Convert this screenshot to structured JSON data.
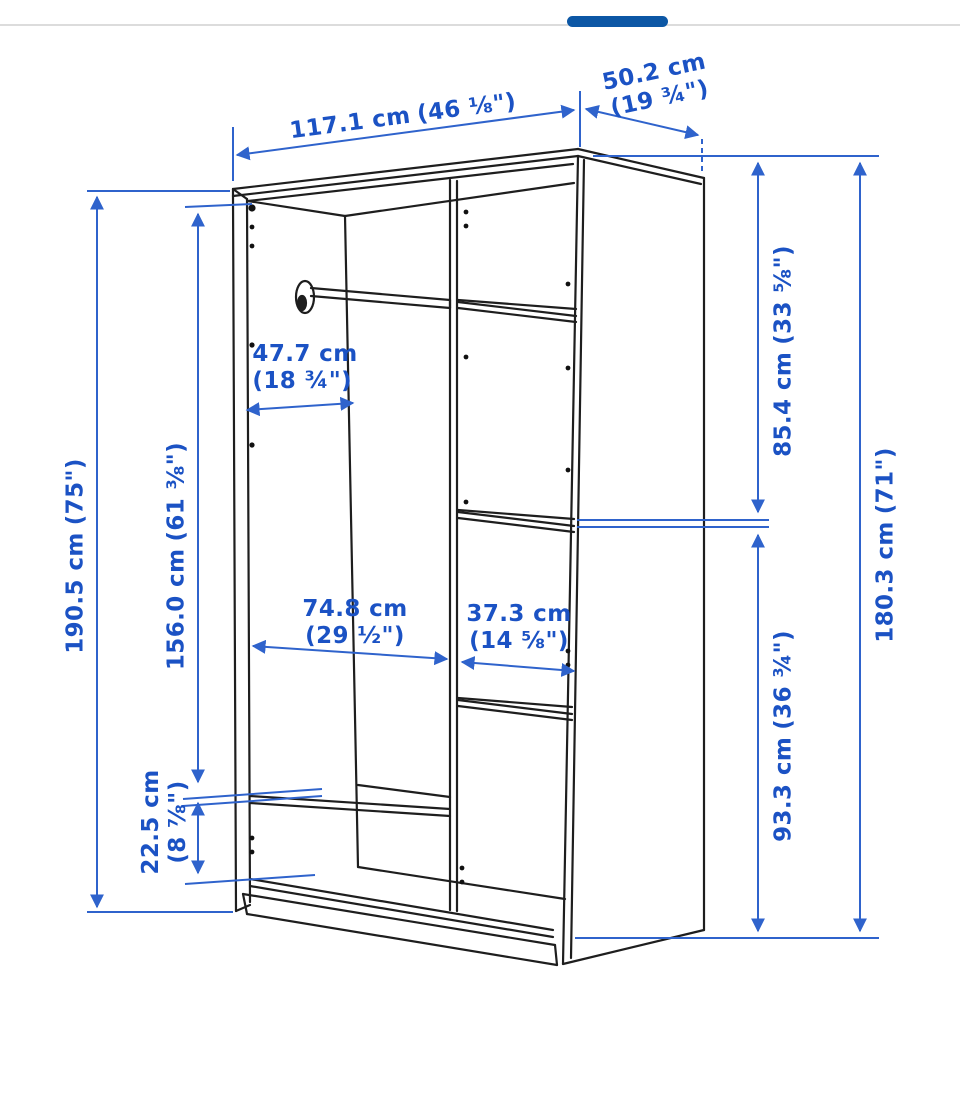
{
  "carousel": {
    "thumb_color": "#0c57a5",
    "track_color": "#dcdcdc"
  },
  "diagram": {
    "subject": "wardrobe dimension line drawing",
    "text_color": "#1b52c4",
    "dimension_line_color": "#2f63cc",
    "drawing_line_color": "#1e1e1e",
    "dimensions": {
      "total_width": {
        "cm": "117.1 cm",
        "inches": "(46 ⅛\")"
      },
      "depth": {
        "cm": "50.2 cm",
        "inches": "(19 ¾\")"
      },
      "total_height": {
        "cm": "190.5 cm",
        "inches": "(75\")"
      },
      "interior_height": {
        "cm": "156.0 cm",
        "inches": "(61 ⅜\")"
      },
      "interior_depth": {
        "cm": "47.7 cm",
        "inches": "(18 ¾\")"
      },
      "left_section_width": {
        "cm": "74.8 cm",
        "inches": "(29 ½\")"
      },
      "right_section_width": {
        "cm": "37.3 cm",
        "inches": "(14 ⅝\")"
      },
      "bottom_compartment_height": {
        "cm": "22.5 cm",
        "inches": "(8 ⅞\")"
      },
      "upper_right_height": {
        "cm": "85.4 cm",
        "inches": "(33 ⅝\")"
      },
      "lower_right_height": {
        "cm": "93.3 cm",
        "inches": "(36 ¾\")"
      },
      "side_height": {
        "cm": "180.3 cm",
        "inches": "(71\")"
      }
    }
  }
}
